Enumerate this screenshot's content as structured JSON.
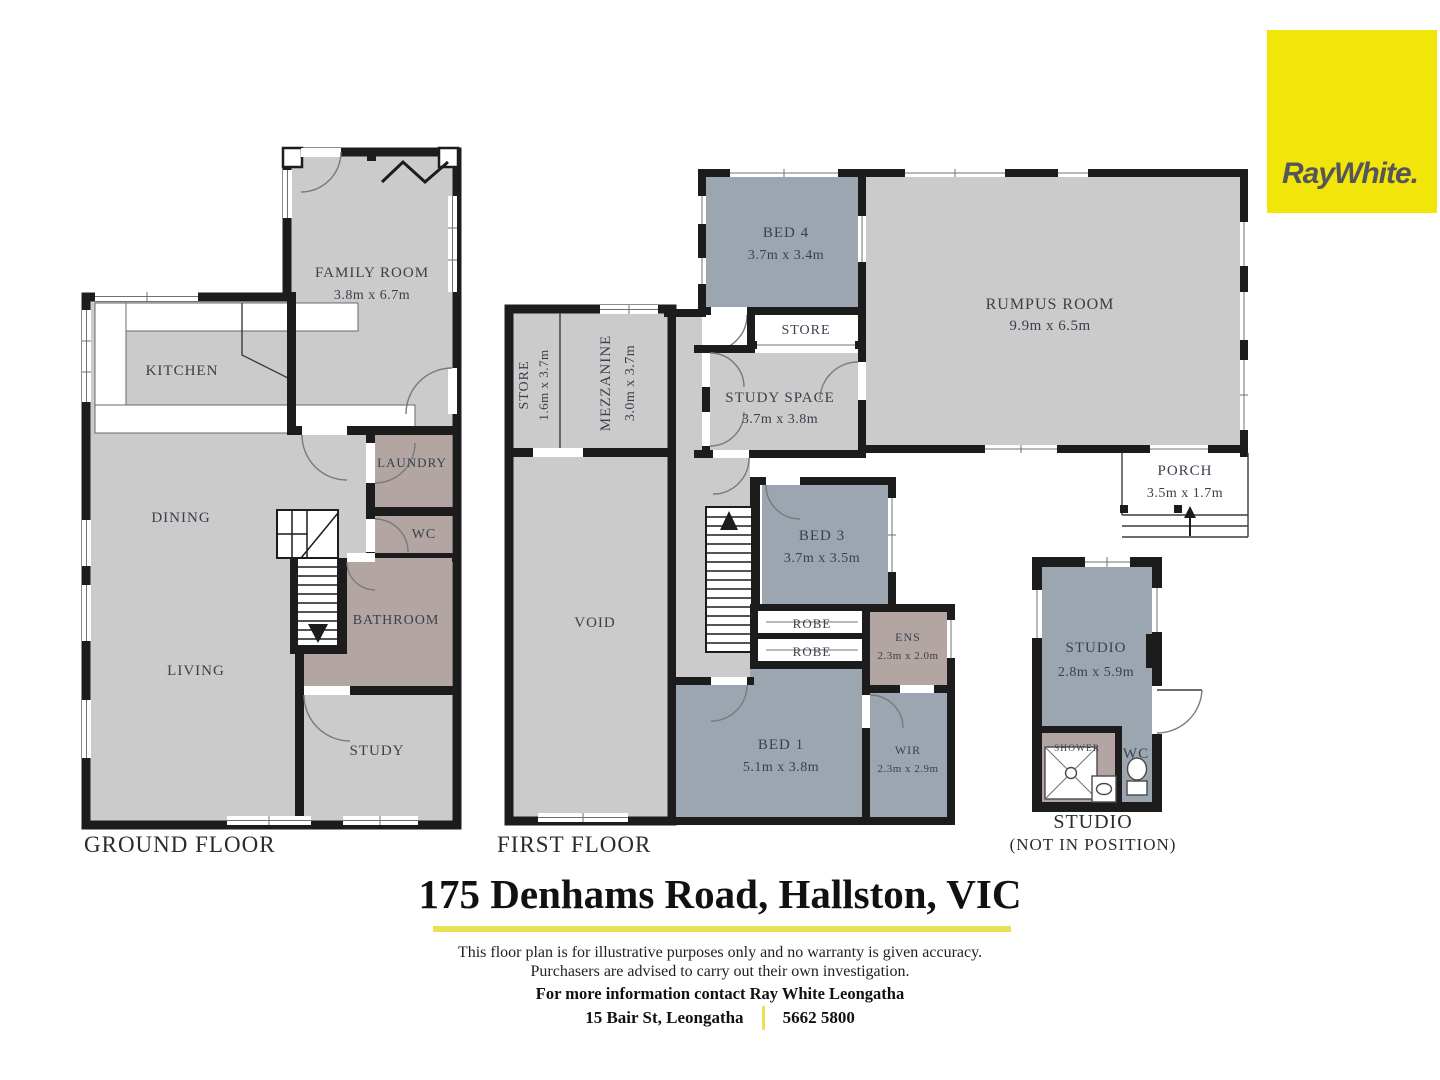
{
  "brand": {
    "logo_text": "RayWhite."
  },
  "colors": {
    "brand_yellow": "#F2E50A",
    "underline_yellow": "#EAE154",
    "room_gray": "#CBCBCB",
    "room_bluegray": "#9CA6B1",
    "room_mauve": "#B3A6A2",
    "wall_black": "#1C1C1C",
    "label_text": "#39404C"
  },
  "floors": {
    "ground": {
      "label": "GROUND FLOOR",
      "rooms": {
        "family": {
          "name": "FAMILY ROOM",
          "dims": "3.8m x 6.7m"
        },
        "kitchen": {
          "name": "KITCHEN"
        },
        "laundry": {
          "name": "LAUNDRY"
        },
        "wc": {
          "name": "WC"
        },
        "dining": {
          "name": "DINING"
        },
        "bathroom": {
          "name": "BATHROOM"
        },
        "living": {
          "name": "LIVING"
        },
        "study": {
          "name": "STUDY"
        }
      }
    },
    "first": {
      "label": "FIRST FLOOR",
      "rooms": {
        "store_tall": {
          "name": "STORE",
          "dims": "1.6m x 3.7m"
        },
        "mezzanine": {
          "name": "MEZZANINE",
          "dims": "3.0m x 3.7m"
        },
        "bed4": {
          "name": "BED 4",
          "dims": "3.7m x 3.4m"
        },
        "store": {
          "name": "STORE"
        },
        "rumpus": {
          "name": "RUMPUS ROOM",
          "dims": "9.9m x 6.5m"
        },
        "study_space": {
          "name": "STUDY SPACE",
          "dims": "3.7m x 3.8m"
        },
        "porch": {
          "name": "PORCH",
          "dims": "3.5m x 1.7m"
        },
        "bed3": {
          "name": "BED 3",
          "dims": "3.7m x 3.5m"
        },
        "void": {
          "name": "VOID"
        },
        "robe1": {
          "name": "ROBE"
        },
        "robe2": {
          "name": "ROBE"
        },
        "ens": {
          "name": "ENS",
          "dims": "2.3m x 2.0m"
        },
        "bed1": {
          "name": "BED 1",
          "dims": "5.1m x 3.8m"
        },
        "wir": {
          "name": "WIR",
          "dims": "2.3m x 2.9m"
        }
      }
    },
    "studio": {
      "caption1": "STUDIO",
      "caption2": "(NOT IN POSITION)",
      "rooms": {
        "studio": {
          "name": "STUDIO",
          "dims": "2.8m x 5.9m"
        },
        "shower": {
          "name": "SHOWER"
        },
        "wc": {
          "name": "WC"
        }
      }
    }
  },
  "footer": {
    "address": "175 Denhams Road, Hallston, VIC",
    "disclaimer1": "This floor plan is for illustrative purposes only and no warranty is given accuracy.",
    "disclaimer2": "Purchasers are advised to carry out their own investigation.",
    "contact": "For more information contact Ray White Leongatha",
    "office": "15 Bair St, Leongatha",
    "phone": "5662 5800"
  }
}
